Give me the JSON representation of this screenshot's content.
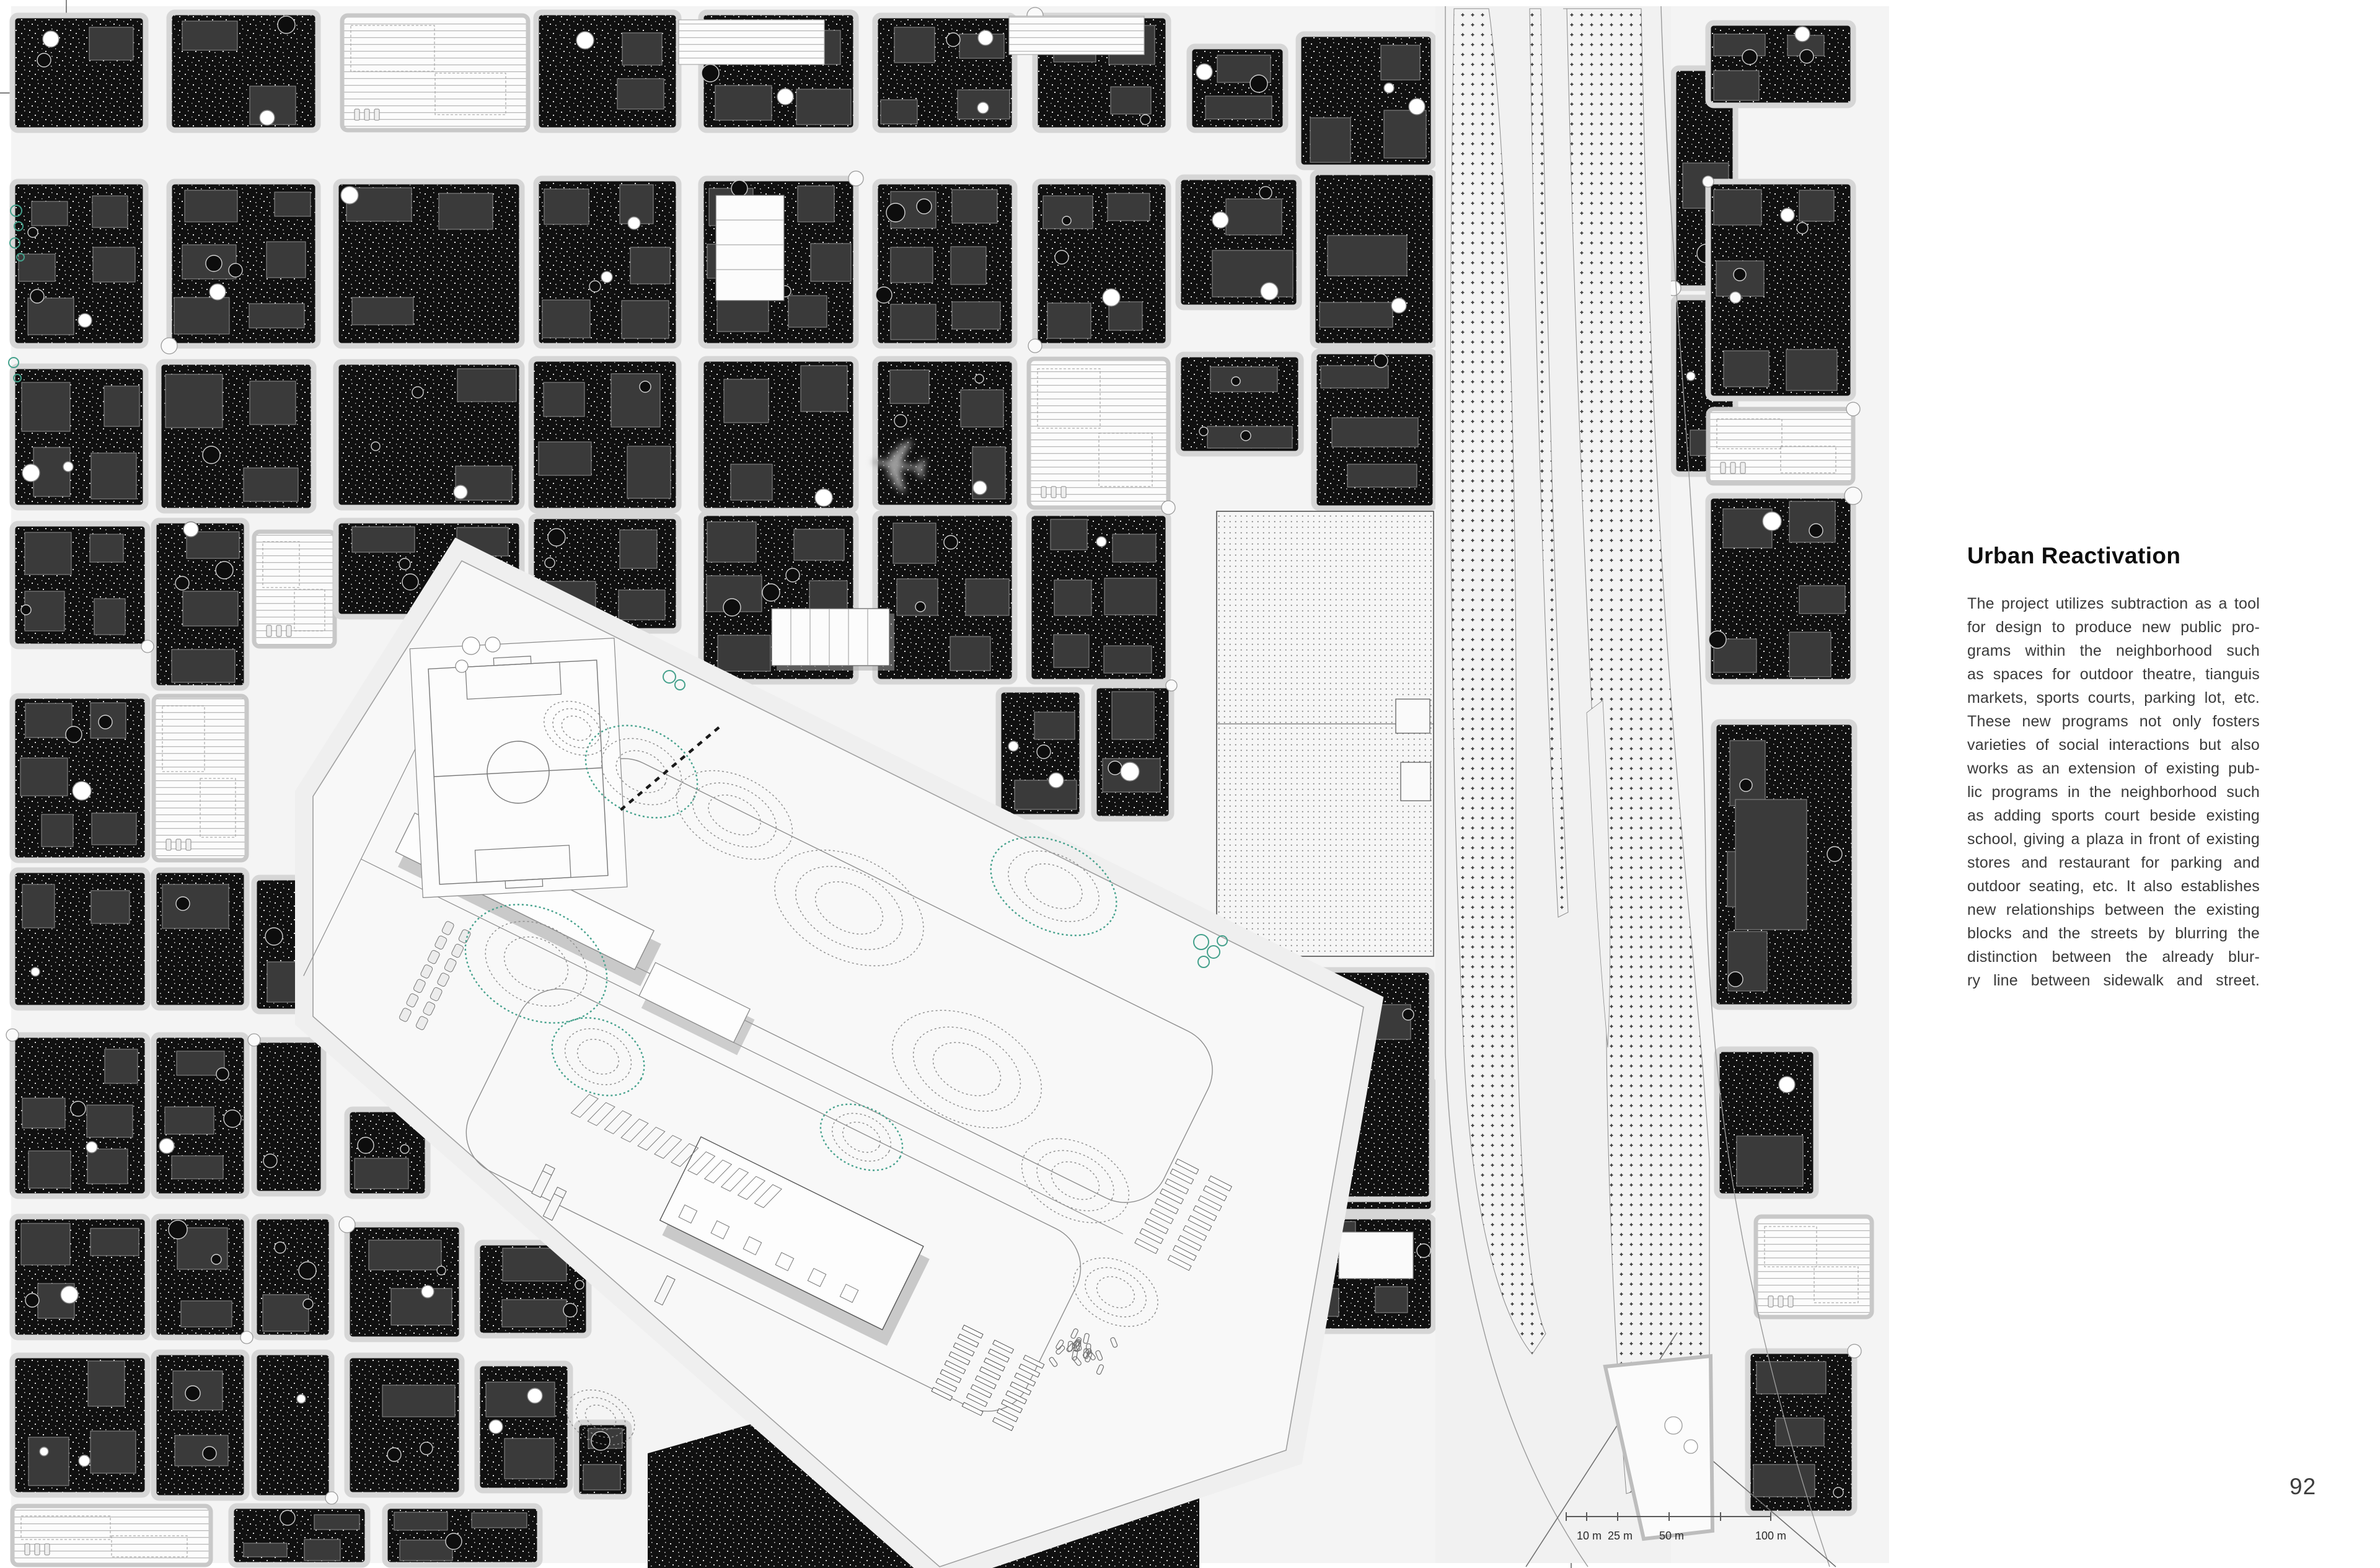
{
  "page": {
    "number": "92",
    "background": "#ffffff"
  },
  "article": {
    "title": "Urban Reactivation",
    "lines": [
      "The project utilizes subtraction as a tool",
      "for design to produce new public pro-",
      "grams within the neighborhood such",
      "as spaces for outdoor theatre, tianguis",
      "markets, sports courts, parking lot, etc.",
      "These new programs not only fosters",
      "varieties of social interactions but also",
      "works as an extension of existing pub-",
      "lic programs in the neighborhood such",
      "as adding sports court beside existing",
      "school, giving a plaza in front of existing",
      "stores and restaurant for parking and",
      "outdoor seating, etc. It also establishes",
      "new relationships between the existing",
      "blocks and the streets by blurring the",
      "distinction between the already blur-",
      "ry line between sidewalk and street."
    ]
  },
  "scale_bar": {
    "labels": [
      "10 m",
      "25 m",
      "50 m",
      "100 m"
    ]
  },
  "map": {
    "colors": {
      "accent_teal": "#45a18c",
      "block_fill": "#101010",
      "building_gray": "#3a3a3a",
      "street": "#f4f4f4",
      "site_fill": "#f8f8f8",
      "contour_gray": "#8f8f8f"
    },
    "icons": {
      "airplane_icon": "✈"
    }
  }
}
